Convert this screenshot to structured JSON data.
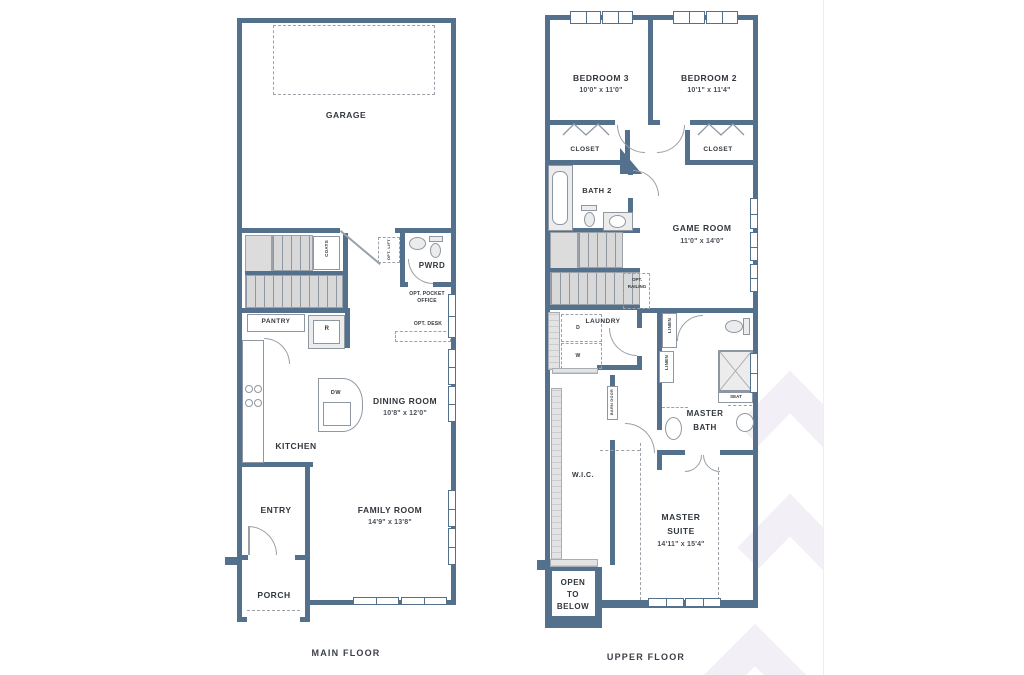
{
  "page": {
    "wall_color": "#53718d",
    "text_color": "#31373e",
    "watermark_color": "#f2eff6"
  },
  "main_floor": {
    "title": "MAIN FLOOR",
    "garage": "GARAGE",
    "coats": "COATS",
    "opt_lift": "OPT. LIFT",
    "pwrd": "PWRD",
    "opt_pocket_office_line1": "OPT. POCKET",
    "opt_pocket_office_line2": "OFFICE",
    "opt_desk": "OPT. DESK",
    "pantry": "PANTRY",
    "fridge": "R",
    "dishwasher": "DW",
    "kitchen": "KITCHEN",
    "dining_room": "DINING ROOM",
    "dining_dims": "10'8\" x 12'0\"",
    "entry": "ENTRY",
    "family_room": "FAMILY ROOM",
    "family_dims": "14'9\" x 13'8\"",
    "porch": "PORCH"
  },
  "upper_floor": {
    "title": "UPPER FLOOR",
    "bedroom3": "BEDROOM 3",
    "bedroom3_dims": "10'0\" x 11'0\"",
    "bedroom2": "BEDROOM 2",
    "bedroom2_dims": "10'1\" x 11'4\"",
    "closet_left": "CLOSET",
    "closet_right": "CLOSET",
    "bath2": "BATH 2",
    "game_room": "GAME ROOM",
    "game_dims": "11'0\" x 14'0\"",
    "opt_railing_line1": "OPT.",
    "opt_railing_line2": "RAILING",
    "laundry": "LAUNDRY",
    "dryer": "D",
    "washer": "W",
    "linen_upper": "LINEN",
    "linen_lower": "LINEN",
    "barn_door": "BARN DOOR",
    "master_bath_line1": "MASTER",
    "master_bath_line2": "BATH",
    "seat": "SEAT",
    "wic": "W.I.C.",
    "master_suite_line1": "MASTER",
    "master_suite_line2": "SUITE",
    "master_suite_dims": "14'11\" x 15'4\"",
    "open_below_line1": "OPEN",
    "open_below_line2": "TO",
    "open_below_line3": "BELOW"
  }
}
